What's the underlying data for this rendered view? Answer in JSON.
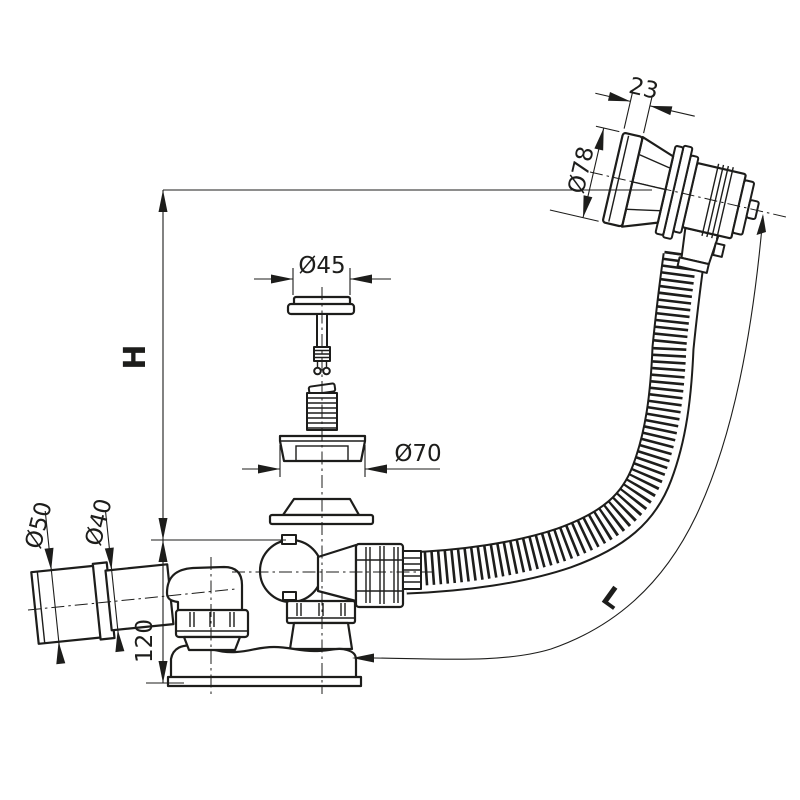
{
  "drawing": {
    "background_color": "#ffffff",
    "line_color": "#1d1d1b",
    "labels": {
      "head_length": "23",
      "head_diameter": "Ø78",
      "plug_cap_diameter": "Ø45",
      "seal_diameter": "Ø70",
      "outlet_socket_diameter": "Ø50",
      "outlet_pipe_diameter": "Ø40",
      "body_height": "120",
      "overall_height": "H",
      "hose_length": "L"
    }
  }
}
